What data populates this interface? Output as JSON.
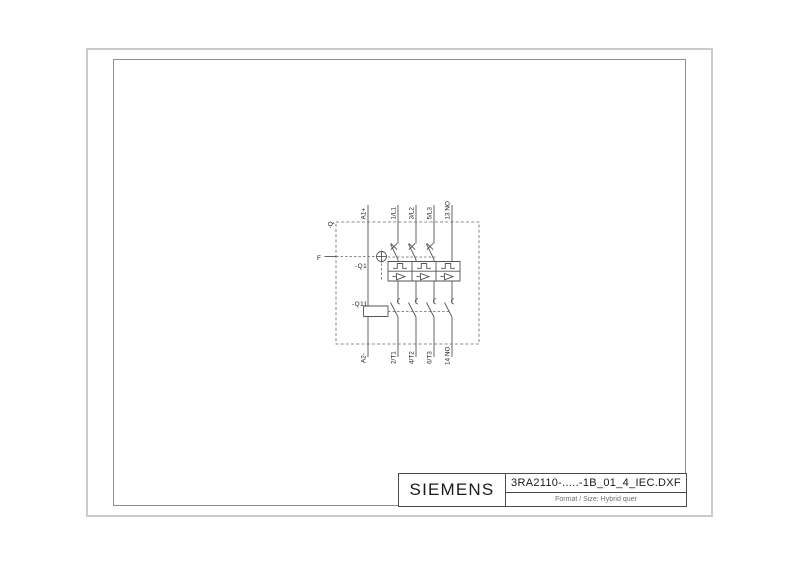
{
  "title_block": {
    "brand": "SIEMENS",
    "filename": "3RA2110-.....-1B_01_4_IEC.DXF",
    "format_label": "Format / Size: Hybrid quer"
  },
  "schematic": {
    "frame_label": "-Q",
    "breaker_label": "-Q1",
    "contactor_label": "-Q11",
    "operator_label": "F",
    "top_terminals": [
      "A1+",
      "1/L1",
      "3/L2",
      "5/L3",
      "13 NO"
    ],
    "bottom_terminals": [
      "A2-",
      "2/T1",
      "4/T2",
      "6/T3",
      "14 NO"
    ]
  },
  "colors": {
    "line": "#555555",
    "dashed_line": "#666666",
    "text": "#1a1a1a",
    "frame_outer": "#cbcbcb",
    "frame_inner": "#8f8f8f",
    "titleblock_border": "#4a4a4a",
    "format_text": "#6e6e6e",
    "background": "#ffffff"
  }
}
